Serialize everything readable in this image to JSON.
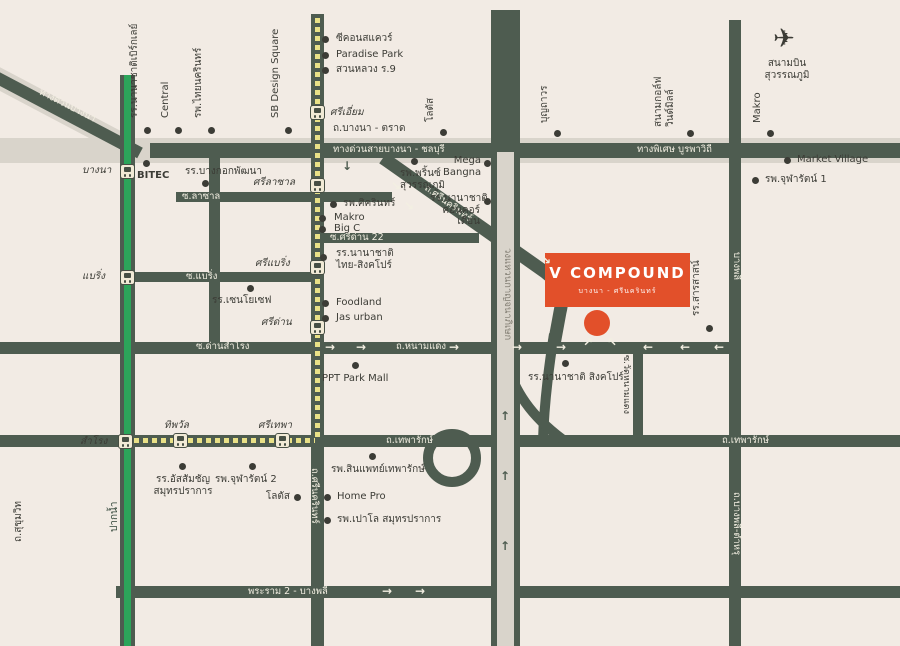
{
  "colors": {
    "background": "#f2ebe4",
    "road": "#4e5c50",
    "elevated_gray": "#d9d4cb",
    "bts_green": "#2ca55a",
    "yellow_line": "#e9e187",
    "accent_orange": "#e2502a",
    "label_dark": "#3c3c36",
    "label_light": "#f3efe2"
  },
  "logo": {
    "title": "V COMPOUND",
    "subtitle": "บางนา - ศรีนครินทร์"
  },
  "airport": {
    "name": "สนามบิน\nสุวรรณภูมิ"
  },
  "roads": {
    "bangna_trad": "ถ.บางนา - ตราด",
    "bangna_expwy": "ทางด่วนบางนา",
    "bangna_chonburi_expwy": "ทางด่วนสายบางนา - ชลบุรี",
    "burapha_withi": "ทางพิเศษ บูรพาวิถี",
    "lasalle": "ซ.ลาซาล",
    "bearing_soi": "ซ.แบริ่ง",
    "sridan22": "ซ.ศรีด่าน 22",
    "dan_samrong": "ซ.ด่านสำโรง",
    "nam_daeng": "ถ.หนามแดง",
    "thepharak": "ถ.เทพารักษ์",
    "rama2_bangphli": "พระราม 2 - บางพลี",
    "srinakarin": "ถ.ศรีนครินทร์",
    "srinakarin_south": "ถ.ศรีนครินทร์",
    "kanchanaphisek_ring": "วงแหวนกาญจนาภิเษก",
    "bangphli_dir": "บางพลี",
    "bangphli_tamru": "ถ.บางพลี-ตำหรุ",
    "wat_namdaeng": "ซ.วัดหนามแดง",
    "sukhumvit": "ถ.สุขุมวิท",
    "paknam_dir": "ปากน้ำ"
  },
  "stations": {
    "bts": {
      "bangna": "บางนา",
      "bearing": "แบริ่ง",
      "samrong": "สำโรง"
    },
    "yellow_line": {
      "si_iam": "ศรีเอี่ยม",
      "si_lasalle": "ศรีลาซาล",
      "si_bearing": "ศรีแบริ่ง",
      "si_dan": "ศรีด่าน",
      "si_thepha": "ศรีเทพา",
      "thipawan": "ทิพวัล"
    }
  },
  "places": {
    "berkeley": "รร.นานาชาติเบิร์กเลย์",
    "central": "Central",
    "thainakarin": "รพ.ไทยนครินทร์",
    "sb_design": "SB Design Square",
    "seacon": "ซีคอนสแควร์",
    "paradise_park": "Paradise Park",
    "suan_luang": "สวนหลวง ร.9",
    "lotus_top": "โลตัส",
    "boonthavorn": "บุญถาวร",
    "windmill_golf": "สนามกอล์ฟ\nวินด์มิลล์",
    "makro_top": "Makro",
    "bitec": "BITEC",
    "bangkok_patana": "รร.บางกอกพัฒนา",
    "sikarin": "รพ.ศิครินทร์",
    "makro": "Makro",
    "big_c": "Big C",
    "thai_singapore_school": "รร.นานาชาติ\nไทย-สิงคโปร์",
    "prince_hospital": "รพ.พริ้นซ์\nสุวรรณภูมิ",
    "mega_bangna": "Mega\nBangna",
    "concordian": "รร.นานาชาติ\nคอนคอร์เดียน",
    "market_village": "Market Village",
    "chularat1": "รพ.จุฬารัตน์ 1",
    "sarasas": "รร.สารสาสน์",
    "st_joseph": "รร.เซนโยเซฟ",
    "foodland": "Foodland",
    "jas_urban": "Jas urban",
    "ppt_park_mall": "PPT Park Mall",
    "singapore_school": "รร.นานาชาติ สิงคโปร์",
    "assumption": "รร.อัสสัมชัญ\nสมุทรปราการ",
    "chularat2": "รพ.จุฬารัตน์ 2",
    "lotus_bottom": "โลตัส",
    "synphaet": "รพ.สินแพทย์เทพารักษ์",
    "home_pro": "Home Pro",
    "paolo": "รพ.เปาโล สมุทรปราการ"
  },
  "icons": {
    "airplane": "✈",
    "arrow_right": "→",
    "arrow_left": "←",
    "arrow_up": "↑",
    "arrow_down": "↓",
    "arrow_up_right": "↗",
    "arrow_up_left": "↖",
    "arrow_down_right": "↘"
  }
}
